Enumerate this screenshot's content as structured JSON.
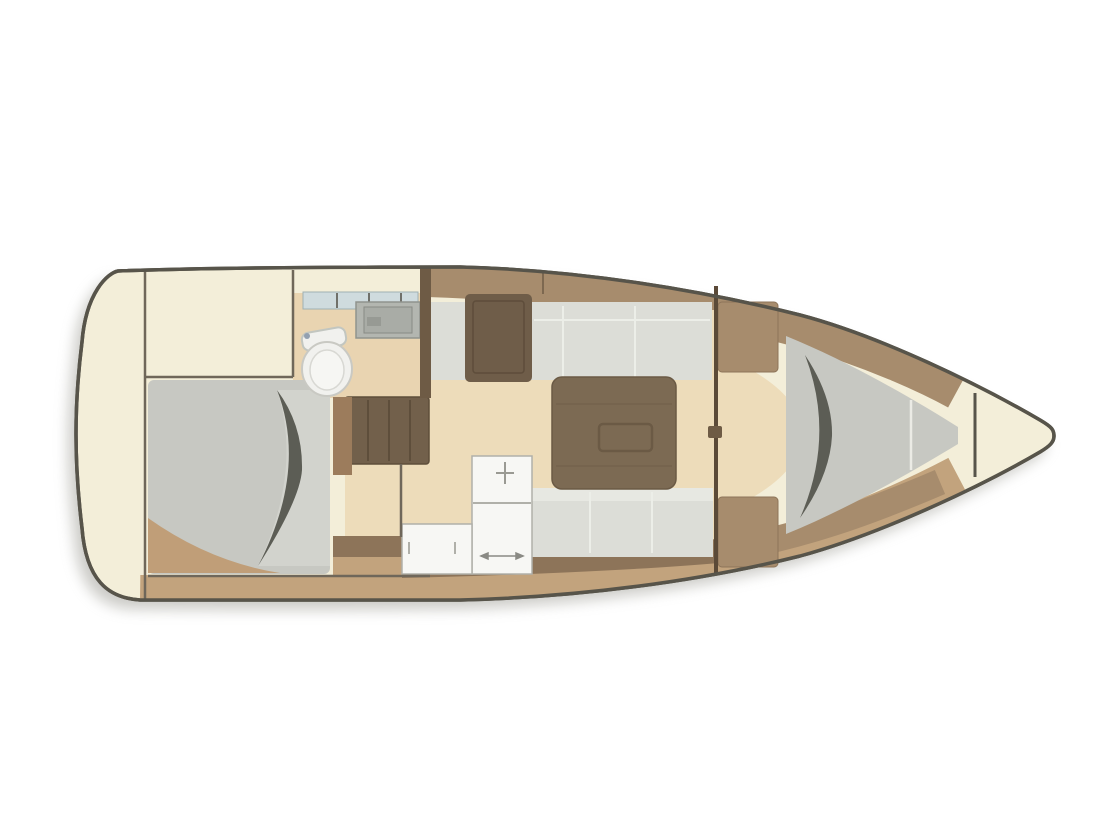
{
  "meta": {
    "title": "Sailboat interior deck plan (top view, bow to the right)",
    "type": "floor-plan",
    "orientation": "bow-right"
  },
  "features": {
    "hull": "sailboat hull outline with drop shadow",
    "stern": "rounded stern platform (left)",
    "aft_cabin": "aft double cabin with large berth",
    "aft_berth": "aft double mattress with fold crease",
    "head": "head compartment with toilet, sink and shelf",
    "companionway": "companionway entry steps",
    "galley": "L-shaped white galley counter",
    "salon": "salon with facing settees",
    "salon_table": "drop-leaf salon table",
    "nav_locker": "locker / seat beside companionway",
    "bulkhead": "forward bulkhead with cabin door",
    "wardrobes": "wardrobe lockers at forward bulkhead",
    "forward_cabin": "forward cabin with V-berth",
    "v_berth": "V-berth mattress with fold crease",
    "anchor_locker": "anchor locker in the bow tip"
  },
  "colors": {
    "background": "#ffffff",
    "shadow": "#98978f",
    "hull_fill": "#f3eed9",
    "hull_outline": "#57544a",
    "floor_beige": "#eddcba",
    "floor_tan": "#e9d4b1",
    "cream": "#f3eed9",
    "deck_tan": "#c2a37d",
    "wedge_tan": "#c09e78",
    "wood": "#a78c6d",
    "wood_dark": "#8d7459",
    "wood_deep": "#6e5b45",
    "wall_line": "#6f675a",
    "wall_brown": "#5b4a38",
    "table": "#7c6a53",
    "table_line": "#6b5a45",
    "stairs": "#72604b",
    "stairs_line": "#5e4e3b",
    "cabinet_small": "#9c7c5c",
    "nav_cabinet": "#6f5d49",
    "upholstery": "#dcddd7",
    "upholstery_light": "#e7e8e2",
    "seam_white": "#eceee8",
    "mattress": "#c7c8c2",
    "mattress_light": "#d2d3cd",
    "crease": "#5c5d55",
    "counter_white": "#f7f7f4",
    "counter_line": "#b0b0a9",
    "shelf_blue": "#cfdbde",
    "shelf_tick": "#70706a",
    "sink_outer": "#b3b6b0",
    "sink_inner": "#a9aca6",
    "sink_mark": "#979a94",
    "fixture_white": "#f1f1ee",
    "fixture_stroke": "#c9c9c3",
    "accent_dot": "#93a0b0"
  }
}
